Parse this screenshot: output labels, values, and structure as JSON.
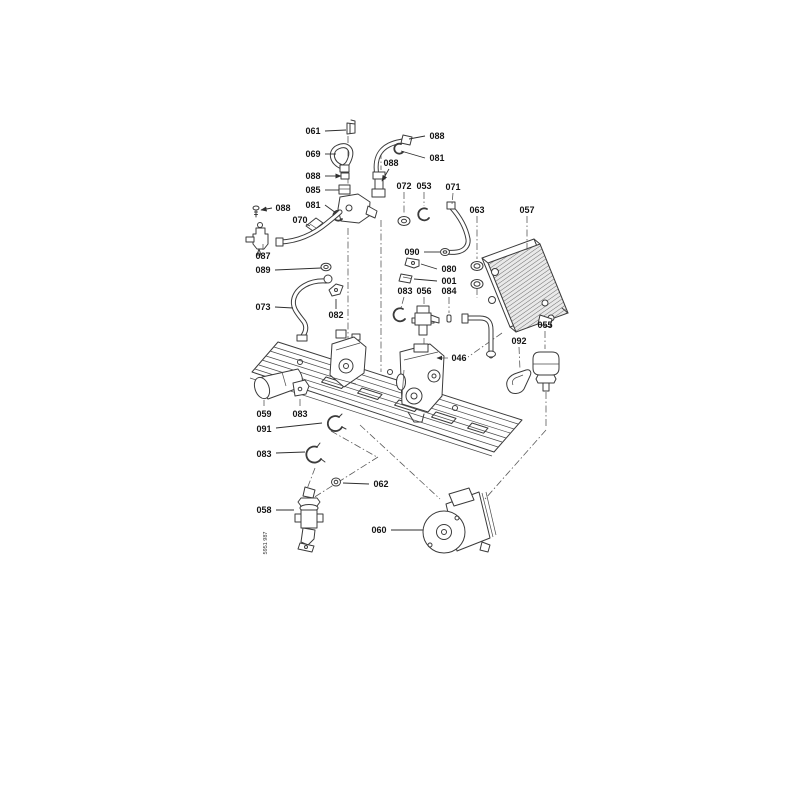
{
  "meta": {
    "description": "Exploded boiler hydraulic-group parts diagram",
    "background_color": "#ffffff",
    "ink_color": "#3b3b3b"
  },
  "diagram": {
    "doc_number": "5951 987",
    "labels": [
      {
        "text": "061",
        "x": 313,
        "y": 134,
        "leader": [
          [
            325,
            131
          ],
          [
            346,
            130
          ]
        ],
        "style": "solid",
        "arrow": false
      },
      {
        "text": "088",
        "x": 437,
        "y": 139,
        "leader": [
          [
            425,
            136
          ],
          [
            409,
            139
          ]
        ],
        "style": "solid",
        "arrow": false
      },
      {
        "text": "069",
        "x": 313,
        "y": 157,
        "leader": [
          [
            325,
            154
          ],
          [
            336,
            154
          ]
        ],
        "style": "solid",
        "arrow": false
      },
      {
        "text": "081",
        "x": 437,
        "y": 161,
        "leader": [
          [
            425,
            158
          ],
          [
            401,
            151
          ]
        ],
        "style": "solid",
        "arrow": false
      },
      {
        "text": "088",
        "x": 391,
        "y": 166,
        "leader": [
          [
            389,
            169
          ],
          [
            382,
            181
          ]
        ],
        "style": "solid",
        "arrow": true
      },
      {
        "text": "088",
        "x": 313,
        "y": 179,
        "leader": [
          [
            325,
            176
          ],
          [
            341,
            176
          ]
        ],
        "style": "solid",
        "arrow": true
      },
      {
        "text": "085",
        "x": 313,
        "y": 193,
        "leader": [
          [
            325,
            190
          ],
          [
            339,
            190
          ]
        ],
        "style": "solid",
        "arrow": false
      },
      {
        "text": "081",
        "x": 313,
        "y": 208,
        "leader": [
          [
            325,
            205
          ],
          [
            336,
            213
          ]
        ],
        "style": "solid",
        "arrow": false
      },
      {
        "text": "072",
        "x": 404,
        "y": 189,
        "leader": [
          [
            404,
            192
          ],
          [
            404,
            214
          ]
        ],
        "style": "dashdot",
        "arrow": false
      },
      {
        "text": "053",
        "x": 424,
        "y": 189,
        "leader": [
          [
            424,
            192
          ],
          [
            424,
            206
          ]
        ],
        "style": "dashdot",
        "arrow": false
      },
      {
        "text": "071",
        "x": 453,
        "y": 190,
        "leader": [
          [
            453,
            193
          ],
          [
            452,
            204
          ]
        ],
        "style": "dashdot",
        "arrow": false
      },
      {
        "text": "063",
        "x": 477,
        "y": 213,
        "leader": [
          [
            477,
            216
          ],
          [
            477,
            259
          ]
        ],
        "style": "dashdot",
        "arrow": false
      },
      {
        "text": "057",
        "x": 527,
        "y": 213,
        "leader": [
          [
            527,
            216
          ],
          [
            527,
            250
          ]
        ],
        "style": "dashdot",
        "arrow": false
      },
      {
        "text": "088",
        "x": 283,
        "y": 211,
        "leader": [
          [
            272,
            208
          ],
          [
            261,
            210
          ]
        ],
        "style": "solid",
        "arrow": true
      },
      {
        "text": "070",
        "x": 300,
        "y": 223,
        "leader": [
          [
            306,
            224
          ],
          [
            310,
            226
          ]
        ],
        "style": "solid",
        "arrow": false
      },
      {
        "text": "087",
        "x": 263,
        "y": 259,
        "leader": [
          [
            263,
            250
          ],
          [
            263,
            244
          ]
        ],
        "style": "dashdot",
        "arrow": false
      },
      {
        "text": "089",
        "x": 263,
        "y": 273,
        "leader": [
          [
            275,
            270
          ],
          [
            321,
            268
          ]
        ],
        "style": "solid",
        "arrow": false
      },
      {
        "text": "073",
        "x": 263,
        "y": 310,
        "leader": [
          [
            275,
            307
          ],
          [
            293,
            308
          ]
        ],
        "style": "solid",
        "arrow": false
      },
      {
        "text": "082",
        "x": 336,
        "y": 318,
        "leader": [
          [
            336,
            309
          ],
          [
            336,
            299
          ]
        ],
        "style": "solid",
        "arrow": false
      },
      {
        "text": "090",
        "x": 412,
        "y": 255,
        "leader": [
          [
            424,
            252
          ],
          [
            440,
            252
          ]
        ],
        "style": "solid",
        "arrow": false
      },
      {
        "text": "080",
        "x": 449,
        "y": 272,
        "leader": [
          [
            437,
            269
          ],
          [
            421,
            264
          ]
        ],
        "style": "solid",
        "arrow": false
      },
      {
        "text": "001",
        "x": 449,
        "y": 284,
        "leader": [
          [
            437,
            281
          ],
          [
            414,
            279
          ]
        ],
        "style": "solid",
        "arrow": false
      },
      {
        "text": "083",
        "x": 405,
        "y": 294,
        "leader": [
          [
            404,
            297
          ],
          [
            401,
            308
          ]
        ],
        "style": "dashdot",
        "arrow": false
      },
      {
        "text": "056",
        "x": 424,
        "y": 294,
        "leader": [
          [
            424,
            297
          ],
          [
            424,
            305
          ]
        ],
        "style": "dashdot",
        "arrow": false
      },
      {
        "text": "084",
        "x": 449,
        "y": 294,
        "leader": [
          [
            449,
            297
          ],
          [
            449,
            313
          ]
        ],
        "style": "dashdot",
        "arrow": false
      },
      {
        "text": "046",
        "x": 459,
        "y": 361,
        "leader": [
          [
            448,
            358
          ],
          [
            437,
            358
          ]
        ],
        "style": "dashdot",
        "arrow": true
      },
      {
        "text": "092",
        "x": 519,
        "y": 344,
        "leader": [
          [
            519,
            347
          ],
          [
            520,
            370
          ]
        ],
        "style": "dashdot",
        "arrow": false
      },
      {
        "text": "055",
        "x": 545,
        "y": 328,
        "leader": [
          [
            545,
            331
          ],
          [
            545,
            349
          ]
        ],
        "style": "dashdot",
        "arrow": false
      },
      {
        "text": "059",
        "x": 264,
        "y": 417,
        "leader": [
          [
            264,
            406
          ],
          [
            264,
            400
          ]
        ],
        "style": "dashdot",
        "arrow": false
      },
      {
        "text": "083",
        "x": 300,
        "y": 417,
        "leader": [
          [
            300,
            406
          ],
          [
            300,
            397
          ]
        ],
        "style": "dashdot",
        "arrow": false
      },
      {
        "text": "091",
        "x": 264,
        "y": 432,
        "leader": [
          [
            276,
            428
          ],
          [
            322,
            423
          ]
        ],
        "style": "solid",
        "arrow": false
      },
      {
        "text": "083",
        "x": 264,
        "y": 457,
        "leader": [
          [
            276,
            453
          ],
          [
            305,
            452
          ]
        ],
        "style": "solid",
        "arrow": false
      },
      {
        "text": "062",
        "x": 381,
        "y": 487,
        "leader": [
          [
            369,
            484
          ],
          [
            343,
            483
          ]
        ],
        "style": "solid",
        "arrow": false
      },
      {
        "text": "058",
        "x": 264,
        "y": 513,
        "leader": [
          [
            276,
            510
          ],
          [
            294,
            510
          ]
        ],
        "style": "solid",
        "arrow": false
      },
      {
        "text": "060",
        "x": 379,
        "y": 533,
        "leader": [
          [
            391,
            530
          ],
          [
            423,
            530
          ]
        ],
        "style": "solid",
        "arrow": false
      }
    ]
  }
}
